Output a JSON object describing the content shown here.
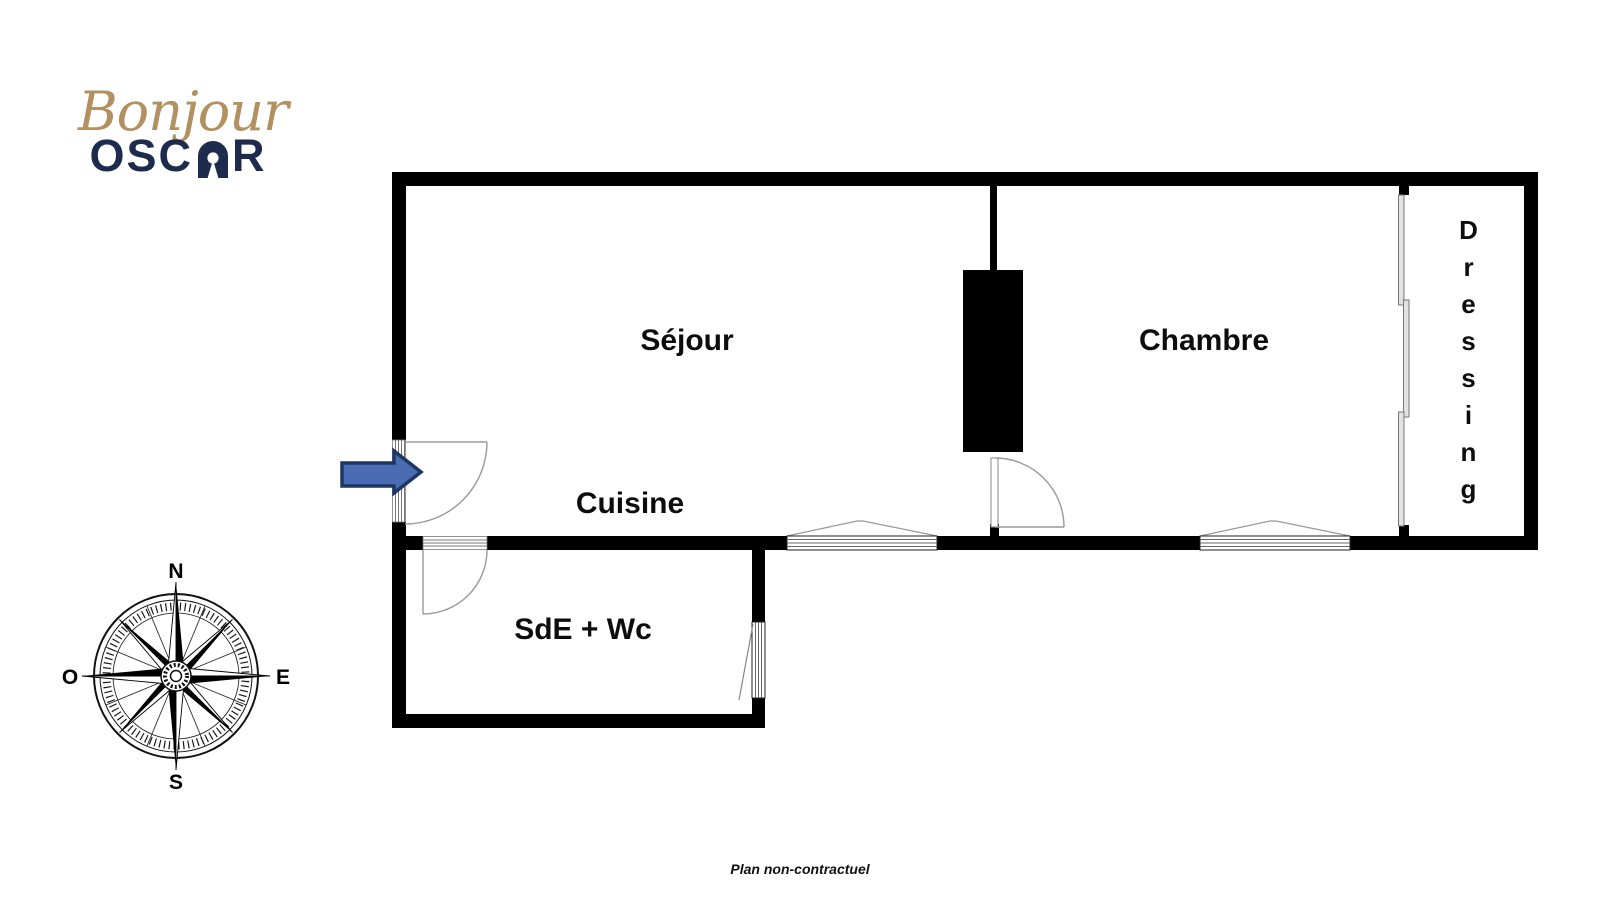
{
  "logo": {
    "script": "Bonjour",
    "word_start": "OSC",
    "word_end": "R"
  },
  "compass": {
    "north": "N",
    "east": "E",
    "south": "S",
    "west": "O"
  },
  "rooms": {
    "sejour": "Séjour",
    "cuisine": "Cuisine",
    "sde": "SdE + Wc",
    "chambre": "Chambre",
    "dressing": "Dressing"
  },
  "footer": {
    "disclaimer": "Plan non-contractuel"
  },
  "colors": {
    "arrow_fill": "#4a6cb4",
    "arrow_stroke": "#1e3662",
    "logo_gold": "#b2905f",
    "logo_navy": "#1d2b4d",
    "wall": "#000000",
    "door_line": "#9a9a9a"
  }
}
